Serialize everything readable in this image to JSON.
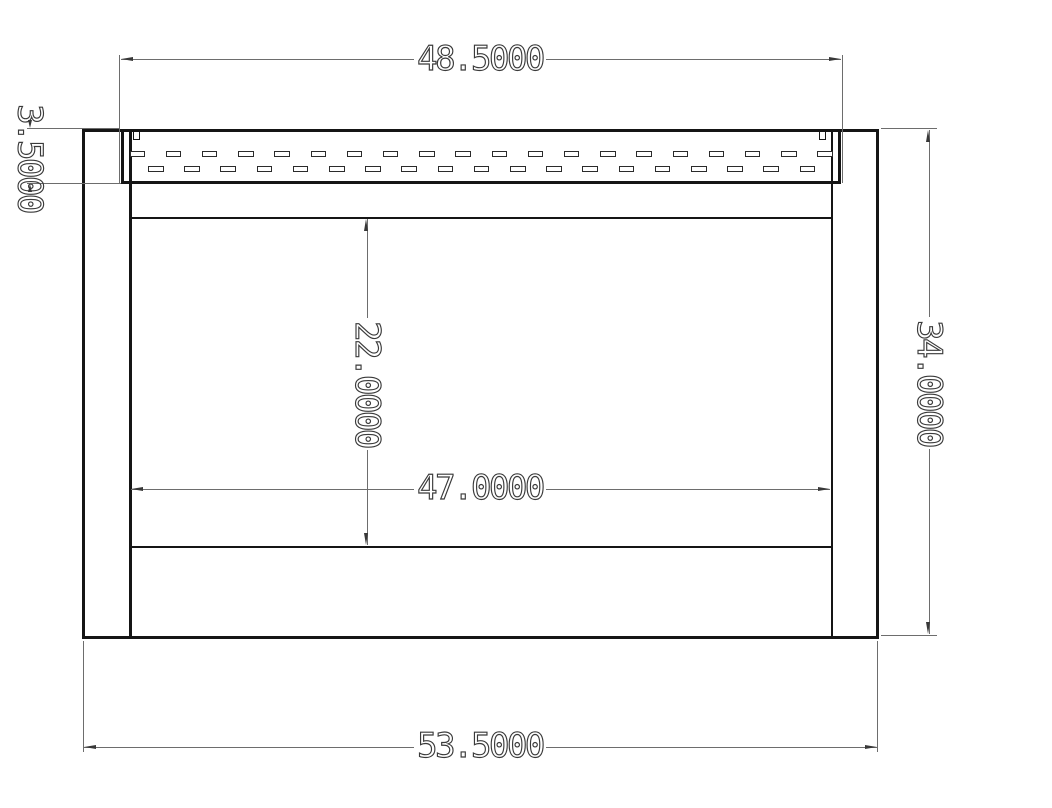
{
  "drawing_type": "cad_dimensioned_front_view",
  "dimensions": {
    "vent_width": "48.5000",
    "vent_height": "3.5000",
    "opening_height": "22.0000",
    "opening_width": "47.0000",
    "overall_height": "34.0000",
    "overall_width": "53.5000"
  },
  "colors": {
    "background": "#ffffff",
    "object_lines": "#151515",
    "dimension_lines": "#6d6d6d",
    "dimension_text": "#3a3a3a"
  }
}
